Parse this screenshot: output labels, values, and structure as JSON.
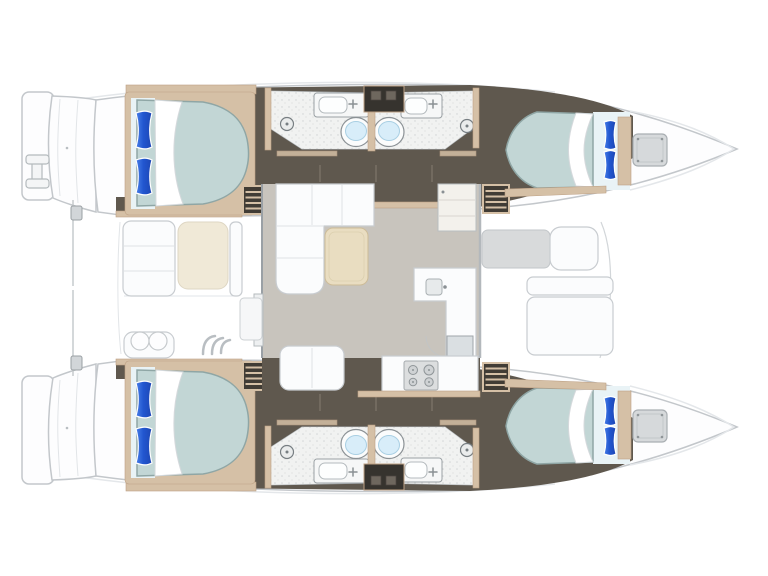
{
  "meta": {
    "title": "Catamaran yacht floor plan",
    "view": "top-down layout diagram, bows pointing right",
    "visible_text": "none"
  },
  "colors": {
    "background": "#ffffff",
    "hullFill": "#fdfdfe",
    "hullStroke": "#c3c7cb",
    "deckLine": "#e4e7ea",
    "floorDark": "#5f584e",
    "floorDarkLine": "#847b70",
    "wood": "#d5c0a6",
    "woodDark": "#bda084",
    "mattress": "#c2d6d5",
    "mattressEdge": "#8fa6a5",
    "linen": "#e9f3f6",
    "pillowBlueLight": "#4a80e8",
    "pillowBlueDark": "#1d46b4",
    "bathFloor": "#f1f2f1",
    "bathStroke": "#a8adb0",
    "fixtureStroke": "#8b9195",
    "toiletWater": "#d8edf9",
    "saloonFloor": "#c8c4bd",
    "furnitureFill": "#fbfcfd",
    "furnitureStroke": "#c8ccd0",
    "tableWood": "#e9ddc1",
    "cushionBeige": "#f0e9d7",
    "padGray": "#d8dadb",
    "hatchGray": "#d6d9db",
    "stoveGray": "#dcdedf",
    "glassDoor": "#dadfe2",
    "cabinetDark": "#36332e"
  },
  "layout": {
    "hulls": [
      "port (top)",
      "starboard (bottom, mirrored)"
    ],
    "per_hull": {
      "aft_cabin": {
        "bed": "double, pillows aft (left)",
        "pillows": 2
      },
      "fwd_cabin": {
        "bed": "double, pillows fwd (right)",
        "pillows": 2
      },
      "heads": [
        {
          "position": "aft",
          "fixtures": [
            "sink",
            "toilet",
            "shower-drain"
          ]
        },
        {
          "position": "fwd",
          "fixtures": [
            "sink",
            "toilet",
            "shower-drain"
          ]
        }
      ],
      "companionway_stairs": 2,
      "bow_hatch": 1
    },
    "saloon": {
      "sofa": "L-shaped, forward-port corner",
      "table": 1,
      "fridge_cabinet": 1,
      "counter_sink": 1,
      "galley_stove_burners": 4,
      "forward_door": 1,
      "aft_sliding_door": 1,
      "bench": 1
    },
    "aft_cockpit": {
      "seats": 2,
      "beige_cushion": 1,
      "helm_double_seat": 1,
      "steps": 3
    },
    "forward_cockpit": {
      "bench_gray": 1,
      "bench_white": 1,
      "sun_pad": 1,
      "headrest": 1
    },
    "stern": {
      "swim_platforms": 2,
      "boarding_ladder": 1,
      "cleats": 2
    }
  }
}
